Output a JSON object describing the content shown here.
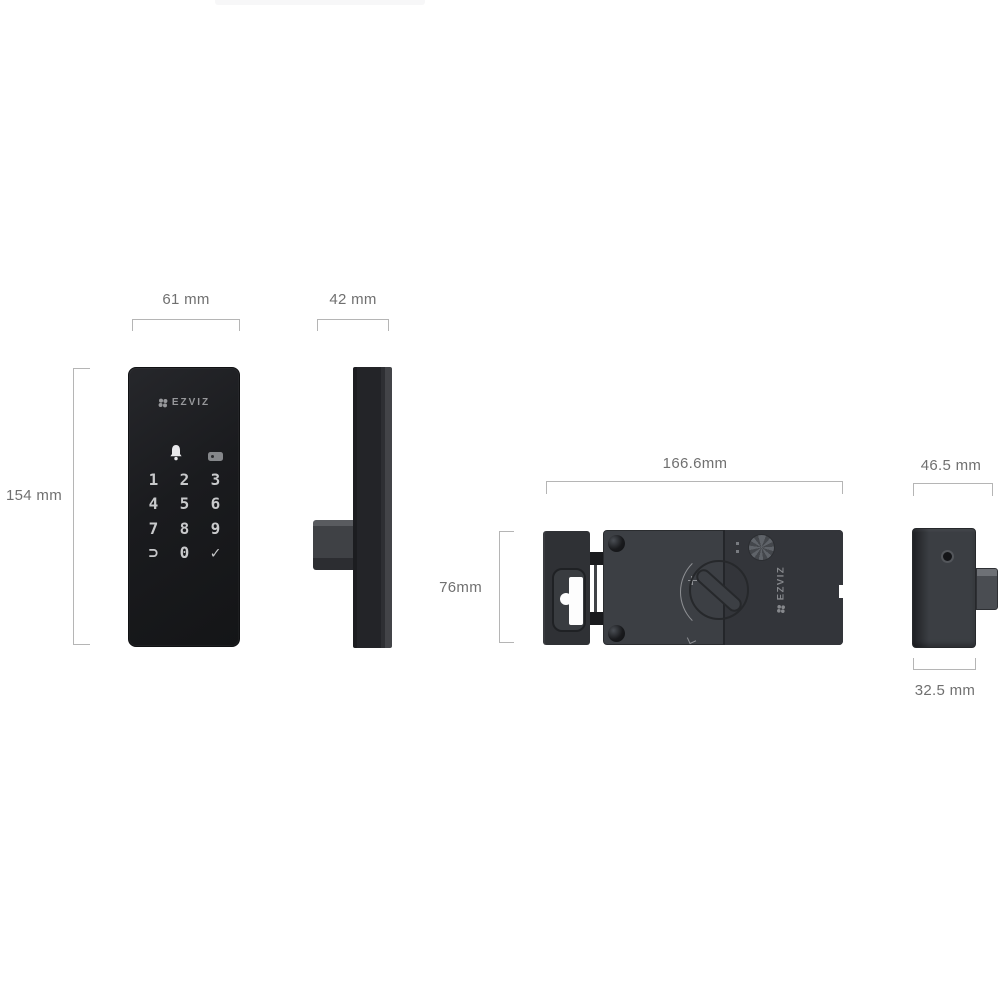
{
  "views": {
    "front": {
      "width_label": "61 mm",
      "height_label": "154 mm",
      "brand": "EZVIZ",
      "keys": [
        "1",
        "2",
        "3",
        "4",
        "5",
        "6",
        "7",
        "8",
        "9",
        "⊃",
        "0",
        "✓"
      ]
    },
    "side": {
      "width_label": "42 mm"
    },
    "rear": {
      "width_label": "166.6mm",
      "height_label": "76mm",
      "brand": "EZVIZ"
    },
    "rear_side": {
      "width_label": "46.5 mm",
      "depth_label": "32.5 mm"
    }
  },
  "colors": {
    "background": "#ffffff",
    "device_black": "#1b1c1f",
    "device_gray": "#3b3e43",
    "dimension_text": "#707070",
    "dimension_line": "#b5b5b5",
    "brand_gray": "#97989b"
  }
}
